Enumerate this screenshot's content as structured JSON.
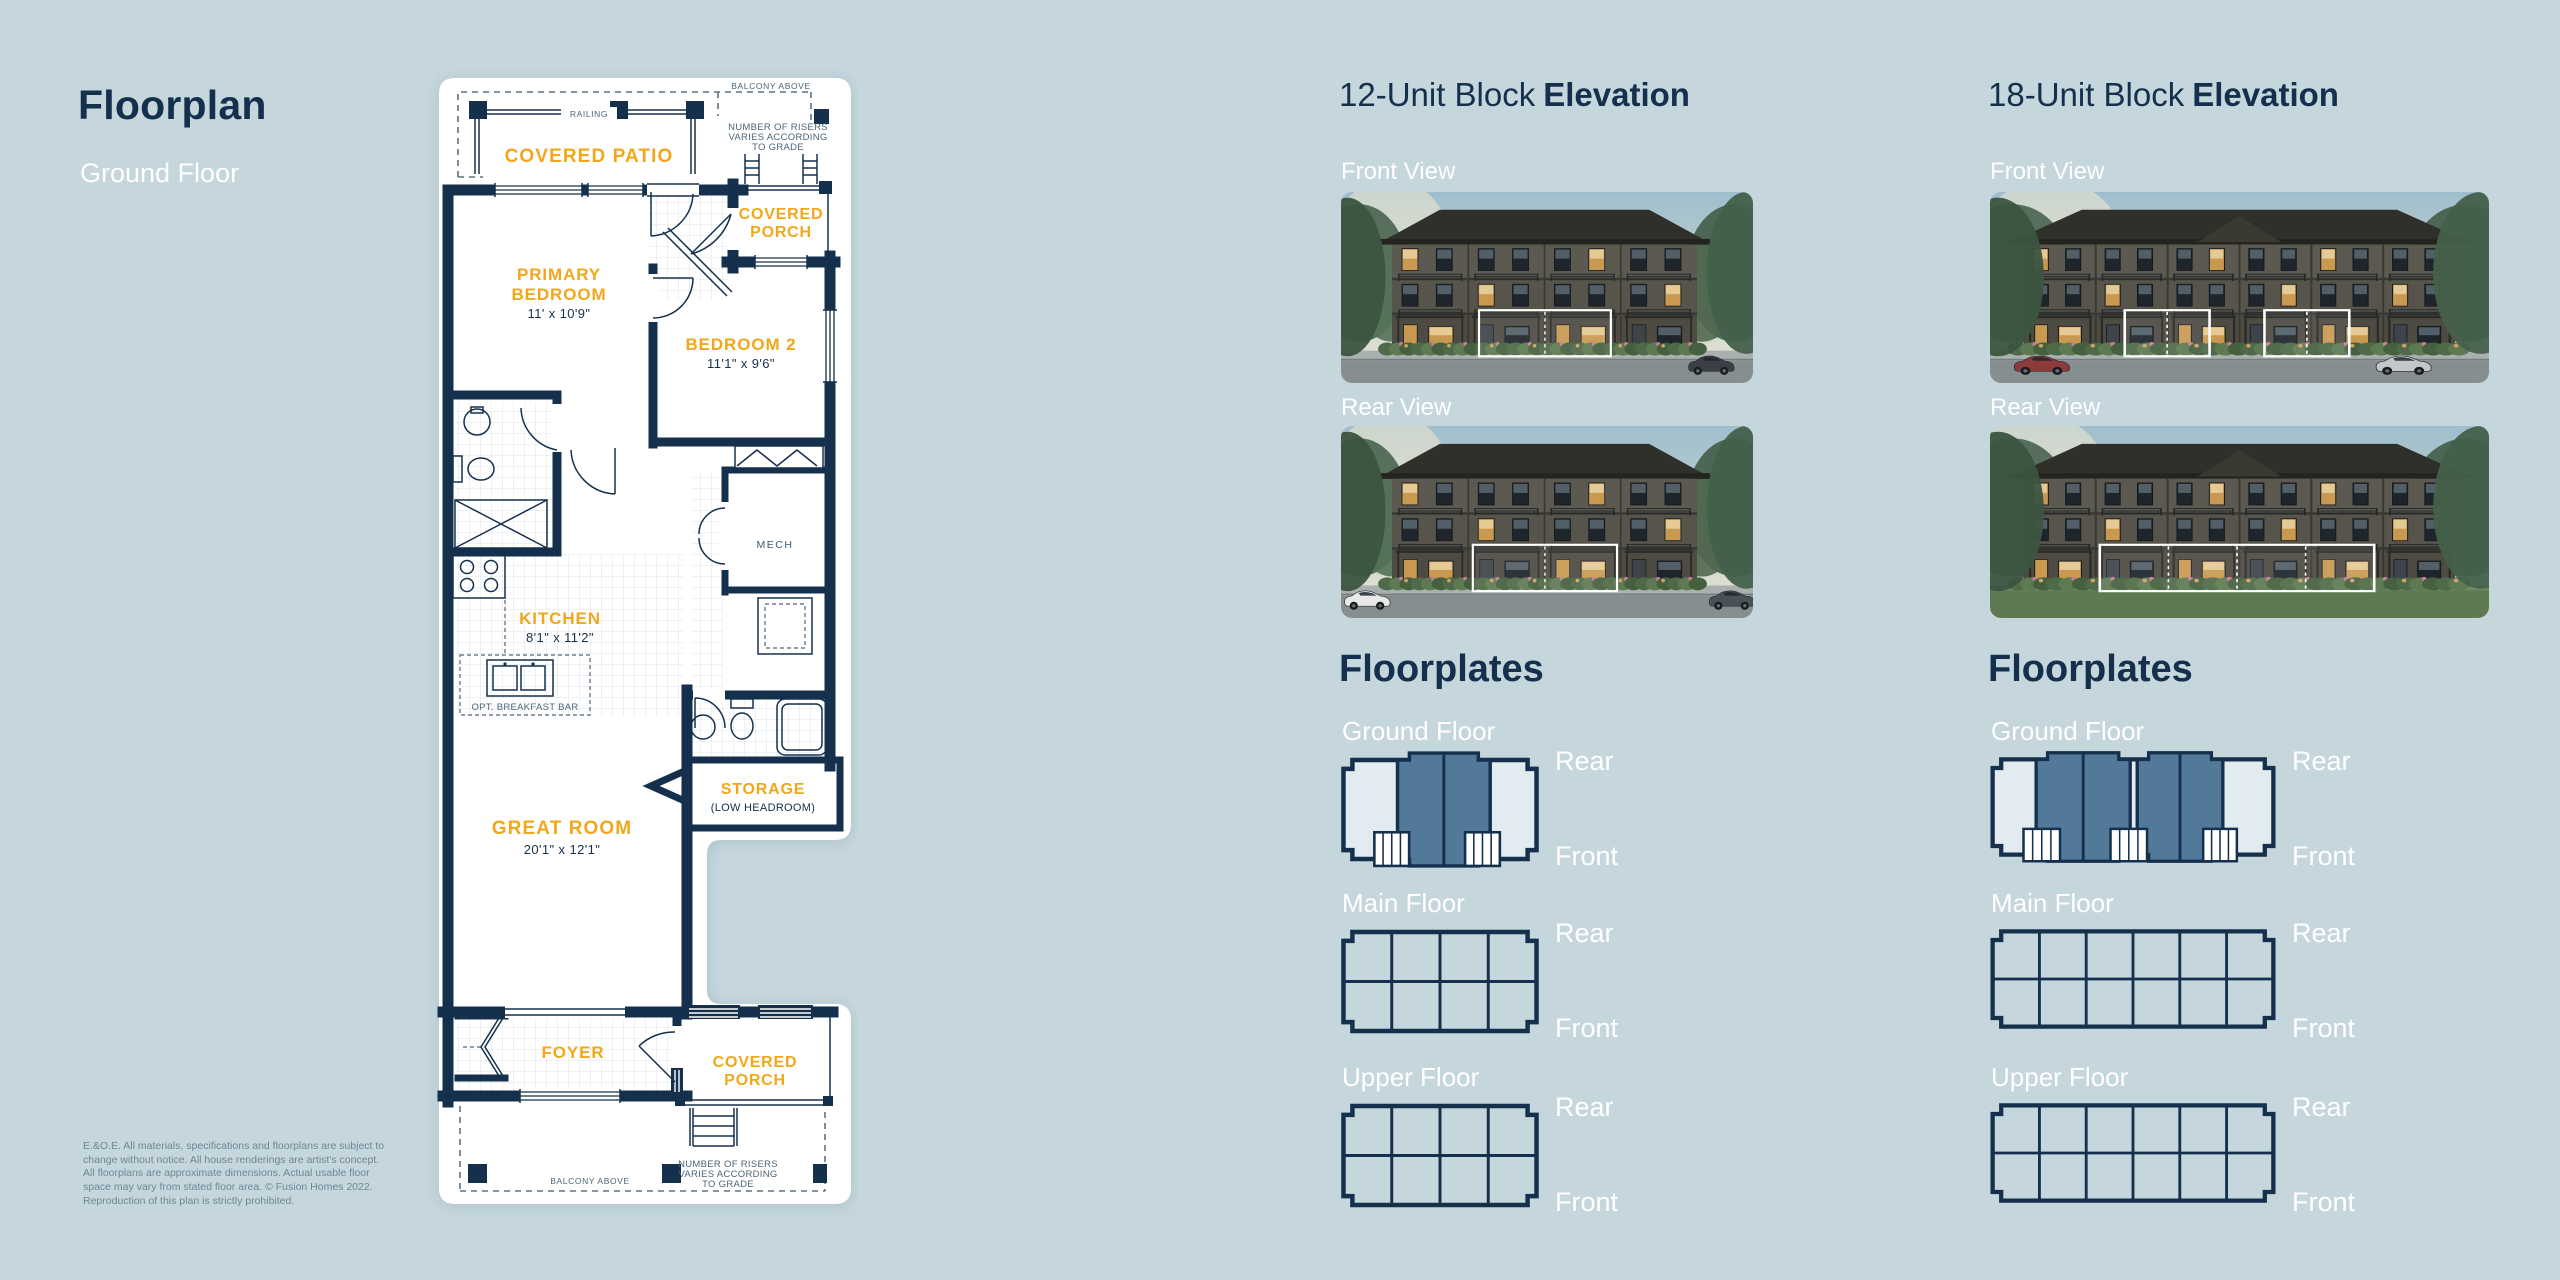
{
  "colors": {
    "background": "#C5D6DD",
    "navy": "#15304C",
    "accent_yellow": "#F2A71B",
    "highlight_slate": "#52789A",
    "plate_fill": "#E2EBEF",
    "label_white": "#FFFFFF"
  },
  "left_panel": {
    "title": "Floorplan",
    "subtitle": "Ground Floor",
    "disclaimer": "E.&O.E. All materials, specifications and floorplans are subject to change without notice. All house renderings are artist's concept. All floorplans are approximate dimensions. Actual usable floor space may vary from stated floor area. © Fusion Homes 2022. Reproduction of this plan is strictly prohibited."
  },
  "floorplan": {
    "labels": {
      "balcony_above": "BALCONY ABOVE",
      "railing": "RAILING",
      "covered_patio": "COVERED PATIO",
      "risers_1": "NUMBER OF RISERS",
      "risers_2": "VARIES ACCORDING",
      "risers_3": "TO GRADE",
      "covered": "COVERED",
      "porch": "PORCH",
      "primary_1": "PRIMARY",
      "primary_2": "BEDROOM",
      "primary_dims": "11' x 10'9\"",
      "bedroom2": "BEDROOM 2",
      "bedroom2_dims": "11'1\" x 9'6\"",
      "mech": "MECH",
      "kitchen": "KITCHEN",
      "kitchen_dims": "8'1\" x 11'2\"",
      "breakfast_bar": "OPT. BREAKFAST BAR",
      "great_room": "GREAT ROOM",
      "great_room_dims": "20'1\" x 12'1\"",
      "storage": "STORAGE",
      "storage_sub": "(LOW HEADROOM)",
      "foyer": "FOYER"
    }
  },
  "blocks": [
    {
      "title": "12-Unit Block",
      "title_bold": "Elevation",
      "front_view_label": "Front View",
      "rear_view_label": "Rear View",
      "floorplates_title": "Floorplates",
      "rear_label": "Rear",
      "front_label": "Front",
      "floors": [
        {
          "label": "Ground Floor"
        },
        {
          "label": "Main Floor"
        },
        {
          "label": "Upper Floor"
        }
      ],
      "elevation_front": {
        "units": 4,
        "building": [
          62,
          432
        ],
        "boxes": [
          [
            0.335,
            0.655
          ]
        ],
        "box_dividers": 1,
        "cars": [
          {
            "x": 0.84,
            "color": "#3A4046"
          }
        ],
        "lawn": false,
        "gable": false
      },
      "elevation_rear": {
        "units": 4,
        "building": [
          62,
          432
        ],
        "boxes": [
          [
            0.32,
            0.67
          ]
        ],
        "box_dividers": 1,
        "cars": [
          {
            "x": 0.005,
            "color": "#E9EAE8"
          },
          {
            "x": 0.89,
            "color": "#4A5157"
          }
        ],
        "lawn": false,
        "gable": false
      },
      "floorplates": [
        {
          "label": "Ground Floor",
          "type": "ground",
          "w": 200,
          "highlights": [
            [
              0.28,
              0.76
            ]
          ],
          "dividers": [
            0.52
          ],
          "stairs": [
            [
              0.16,
              0.34
            ],
            [
              0.63,
              0.81
            ]
          ]
        },
        {
          "label": "Main Floor",
          "type": "grid",
          "w": 200,
          "cols": 4
        },
        {
          "label": "Upper Floor",
          "type": "grid",
          "w": 200,
          "cols": 4
        }
      ]
    },
    {
      "title": "18-Unit Block",
      "title_bold": "Elevation",
      "front_view_label": "Front View",
      "rear_view_label": "Rear View",
      "floorplates_title": "Floorplates",
      "rear_label": "Rear",
      "front_label": "Front",
      "floors": [
        {
          "label": "Ground Floor"
        },
        {
          "label": "Main Floor"
        },
        {
          "label": "Upper Floor"
        }
      ],
      "elevation_front": {
        "units": 6,
        "building": [
          34,
          466
        ],
        "boxes": [
          [
            0.27,
            0.44
          ],
          [
            0.55,
            0.72
          ]
        ],
        "box_dividers": 1,
        "cars": [
          {
            "x": 0.045,
            "color": "#8E3A3A"
          },
          {
            "x": 0.77,
            "color": "#C3C7C9"
          }
        ],
        "lawn": false,
        "gable": true
      },
      "elevation_rear": {
        "units": 6,
        "building": [
          34,
          466
        ],
        "boxes": [
          [
            0.22,
            0.77
          ]
        ],
        "box_dividers": 3,
        "cars": [],
        "lawn": true,
        "gable": true
      },
      "floorplates": [
        {
          "label": "Ground Floor",
          "type": "ground",
          "w": 300,
          "highlights": [
            [
              0.155,
              0.49
            ],
            [
              0.515,
              0.82
            ]
          ],
          "dividers": [
            0.3225,
            0.6675
          ],
          "stairs": [
            [
              0.11,
              0.24
            ],
            [
              0.42,
              0.55
            ],
            [
              0.75,
              0.87
            ]
          ]
        },
        {
          "label": "Main Floor",
          "type": "grid",
          "w": 300,
          "cols": 6
        },
        {
          "label": "Upper Floor",
          "type": "grid",
          "w": 300,
          "cols": 6
        }
      ]
    }
  ]
}
